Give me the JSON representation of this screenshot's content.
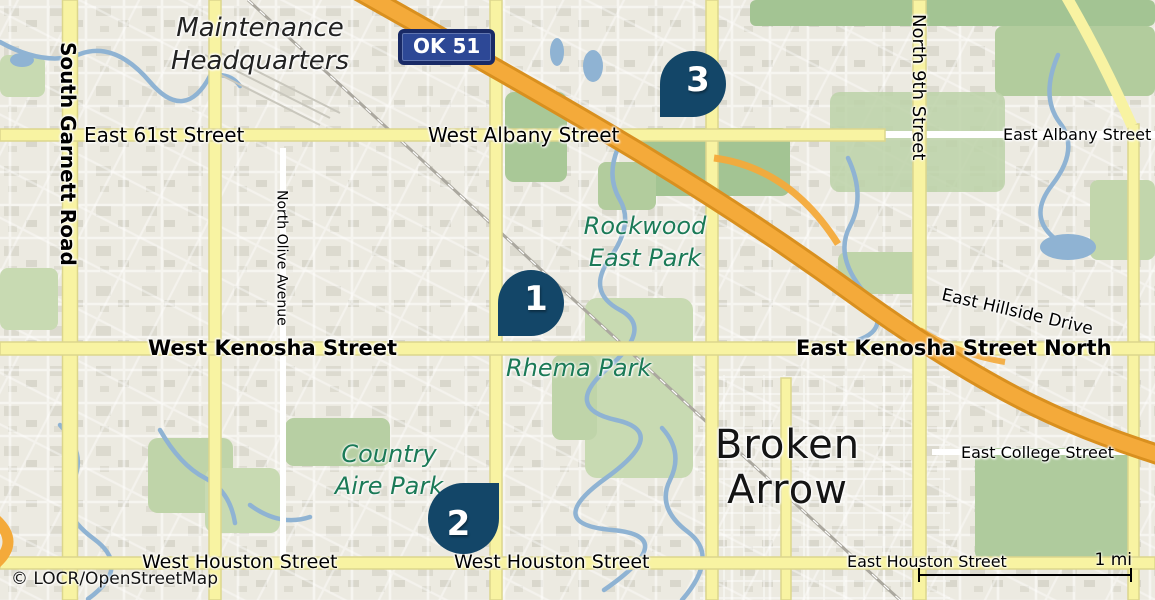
{
  "map": {
    "attribution": "© LOCR/OpenStreetMap",
    "scale_bar": {
      "label": "1 mi"
    },
    "route_shield": {
      "label": "OK 51"
    },
    "city_label": {
      "line1": "Broken",
      "line2": "Arrow"
    },
    "poi_labels": {
      "maintenance_hq_line1": "Maintenance",
      "maintenance_hq_line2": "Headquarters"
    },
    "park_labels": {
      "rockwood_line1": "Rockwood",
      "rockwood_line2": "East Park",
      "rhema": "Rhema Park",
      "country_aire_line1": "Country",
      "country_aire_line2": "Aire Park"
    },
    "street_labels": {
      "east_61st": "East 61st Street",
      "west_albany": "West Albany Street",
      "east_albany": "East Albany Street",
      "north_9th": "North 9th Street",
      "south_garnett": "South Garnett Road",
      "north_olive": "North Olive Avenue",
      "east_hillside": "East Hillside Drive",
      "west_kenosha": "West Kenosha Street",
      "east_kenosha_north": "East Kenosha Street North",
      "east_college": "East College Street",
      "west_houston_left": "West Houston Street",
      "west_houston_center": "West Houston Street",
      "east_houston": "East Houston Street"
    },
    "markers": [
      {
        "number": "1"
      },
      {
        "number": "2"
      },
      {
        "number": "3"
      }
    ],
    "colors": {
      "marker_navy": "#134668",
      "shield_blue": "#2D4896",
      "shield_border": "#192A66",
      "highway_orange": "#F4AA3A",
      "highway_casing": "#D9901F",
      "road_yellow": "#F8F3A2",
      "park_green": "#BFD4A9",
      "water_blue": "#8FB3D3",
      "park_label_green": "#1B7A57",
      "background": "#ECEAE1"
    }
  }
}
